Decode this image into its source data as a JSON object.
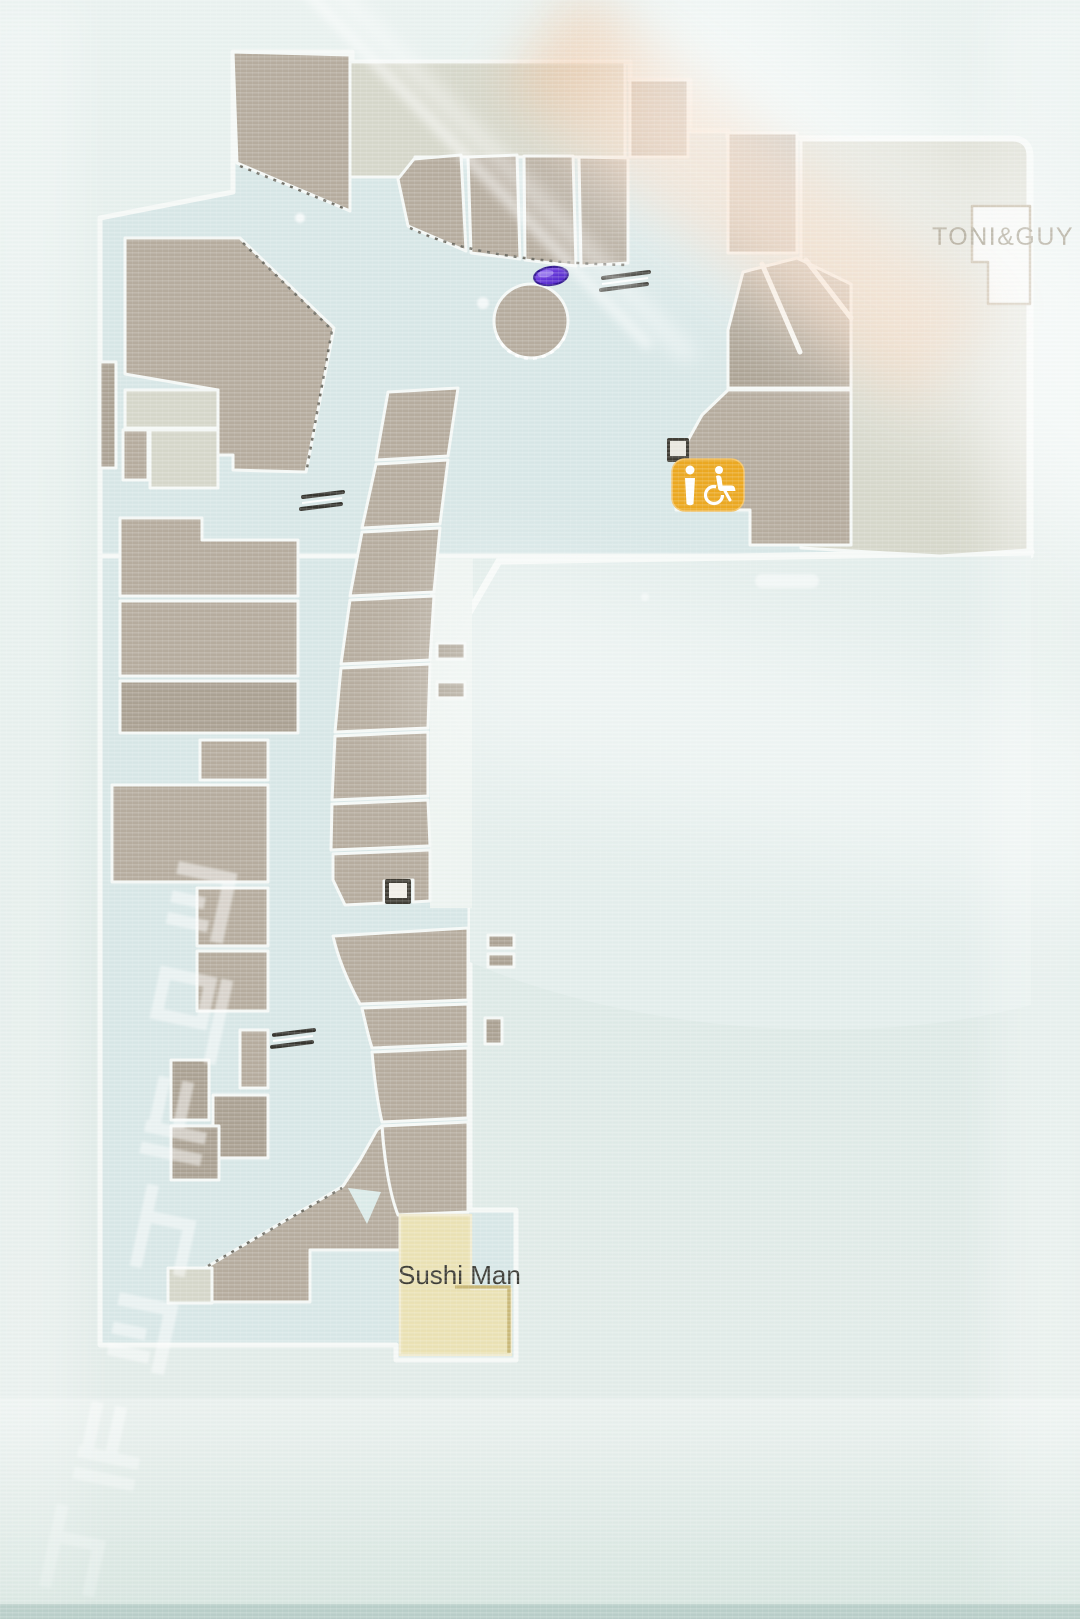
{
  "kiosk_map": {
    "map_type": "mall floor plan",
    "labels": {
      "toni_guy": "TONI&GUY",
      "sushi_man": "Sushi Man"
    },
    "icons": [
      "information-attendant-icon",
      "wheelchair-accessible-icon",
      "elevator-icon",
      "escalator-icon",
      "location-marker"
    ],
    "colors": {
      "icon_badge_orange": "#eca81f",
      "marker_purple": "#5b2fd2",
      "store_fill_tan": "#b6ac9e",
      "store_fill_gray": "#d6d7ca",
      "store_highlight_cream": "#ebe2b4",
      "toni_guy_text": "#73684c",
      "sushi_man_text": "#3c3b35",
      "floor": "#d8e7e7",
      "walkway_white": "#f6f9f7"
    },
    "watermark": {
      "note": "unreadable reflected signage glyphs"
    }
  }
}
